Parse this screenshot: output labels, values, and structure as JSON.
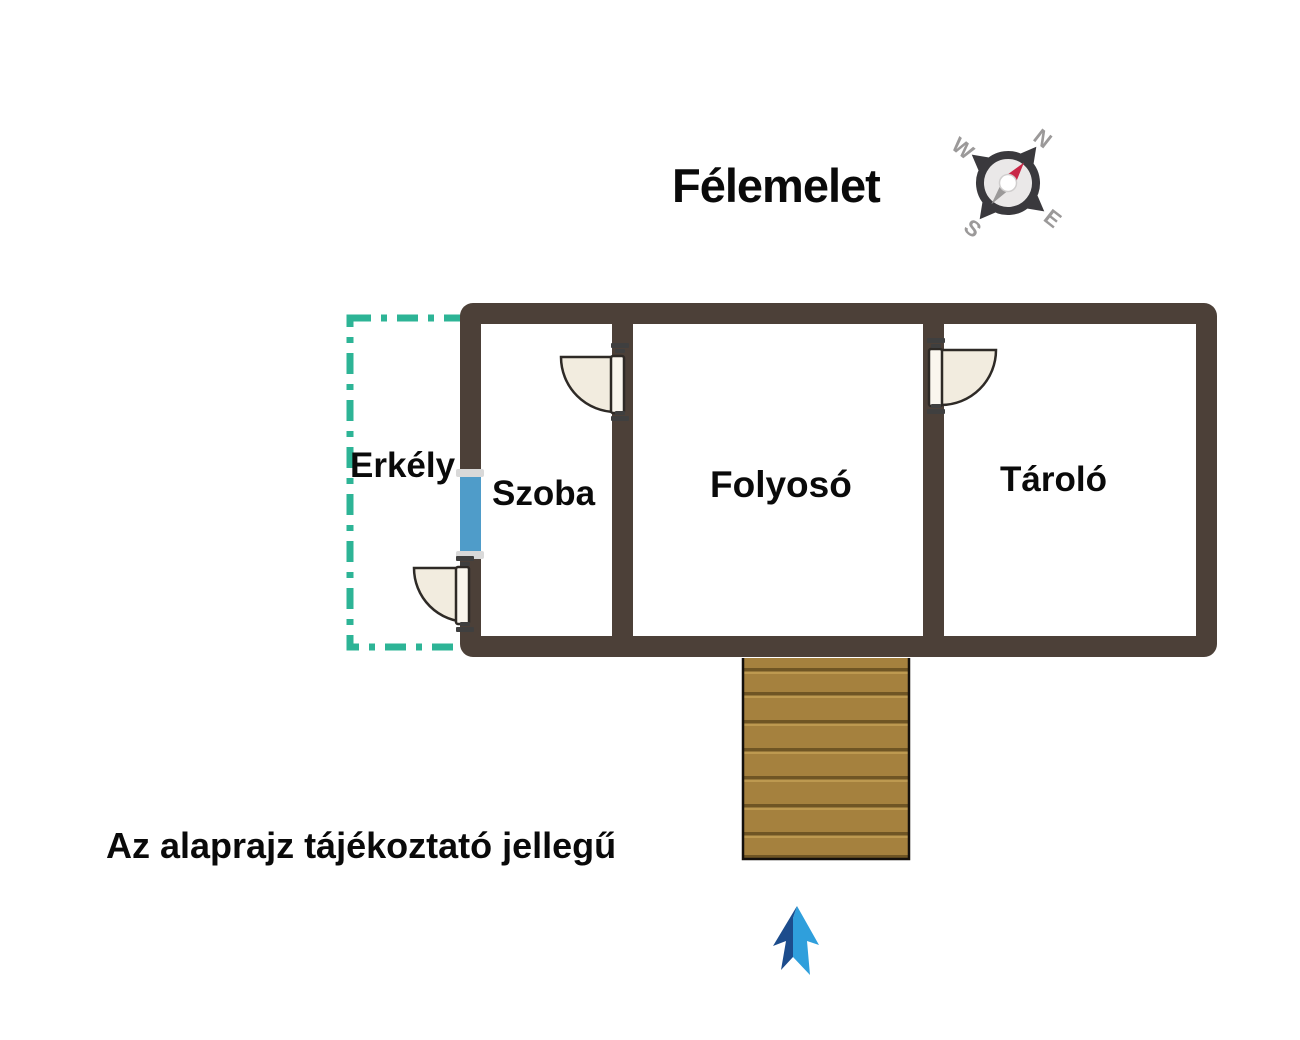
{
  "title": "Félemelet",
  "note": "Az alaprajz tájékoztató jellegű",
  "rooms": [
    {
      "name": "Erkély"
    },
    {
      "name": "Szoba"
    },
    {
      "name": "Folyosó"
    },
    {
      "name": "Tároló"
    }
  ],
  "watermark": {
    "logo": "OC",
    "line1": "OTTHON",
    "line2": "CENTRUM"
  },
  "compass": {
    "n": "N",
    "e": "E",
    "s": "S",
    "w": "W"
  },
  "colors": {
    "label_text": "#0a0a0a",
    "wall": "#4c4038",
    "balcony_outline": "#2db496",
    "window": "#4f9cc9",
    "door_fill": "#f2ecdf",
    "door_stroke": "#2e2a26",
    "stairs_wood": "#a5813e",
    "stairs_groove": "#6f5524",
    "stairs_highlight": "#c6a257",
    "watermark_gray": "#b6b4b4",
    "arrow_dark": "#1c4c8c",
    "arrow_light": "#2f9fdc",
    "compass_ring": "#3a393d",
    "compass_face": "#eae8e8",
    "compass_letters": "#9b9999",
    "compass_needle_red": "#c92747",
    "compass_needle_gray": "#9b9999"
  }
}
